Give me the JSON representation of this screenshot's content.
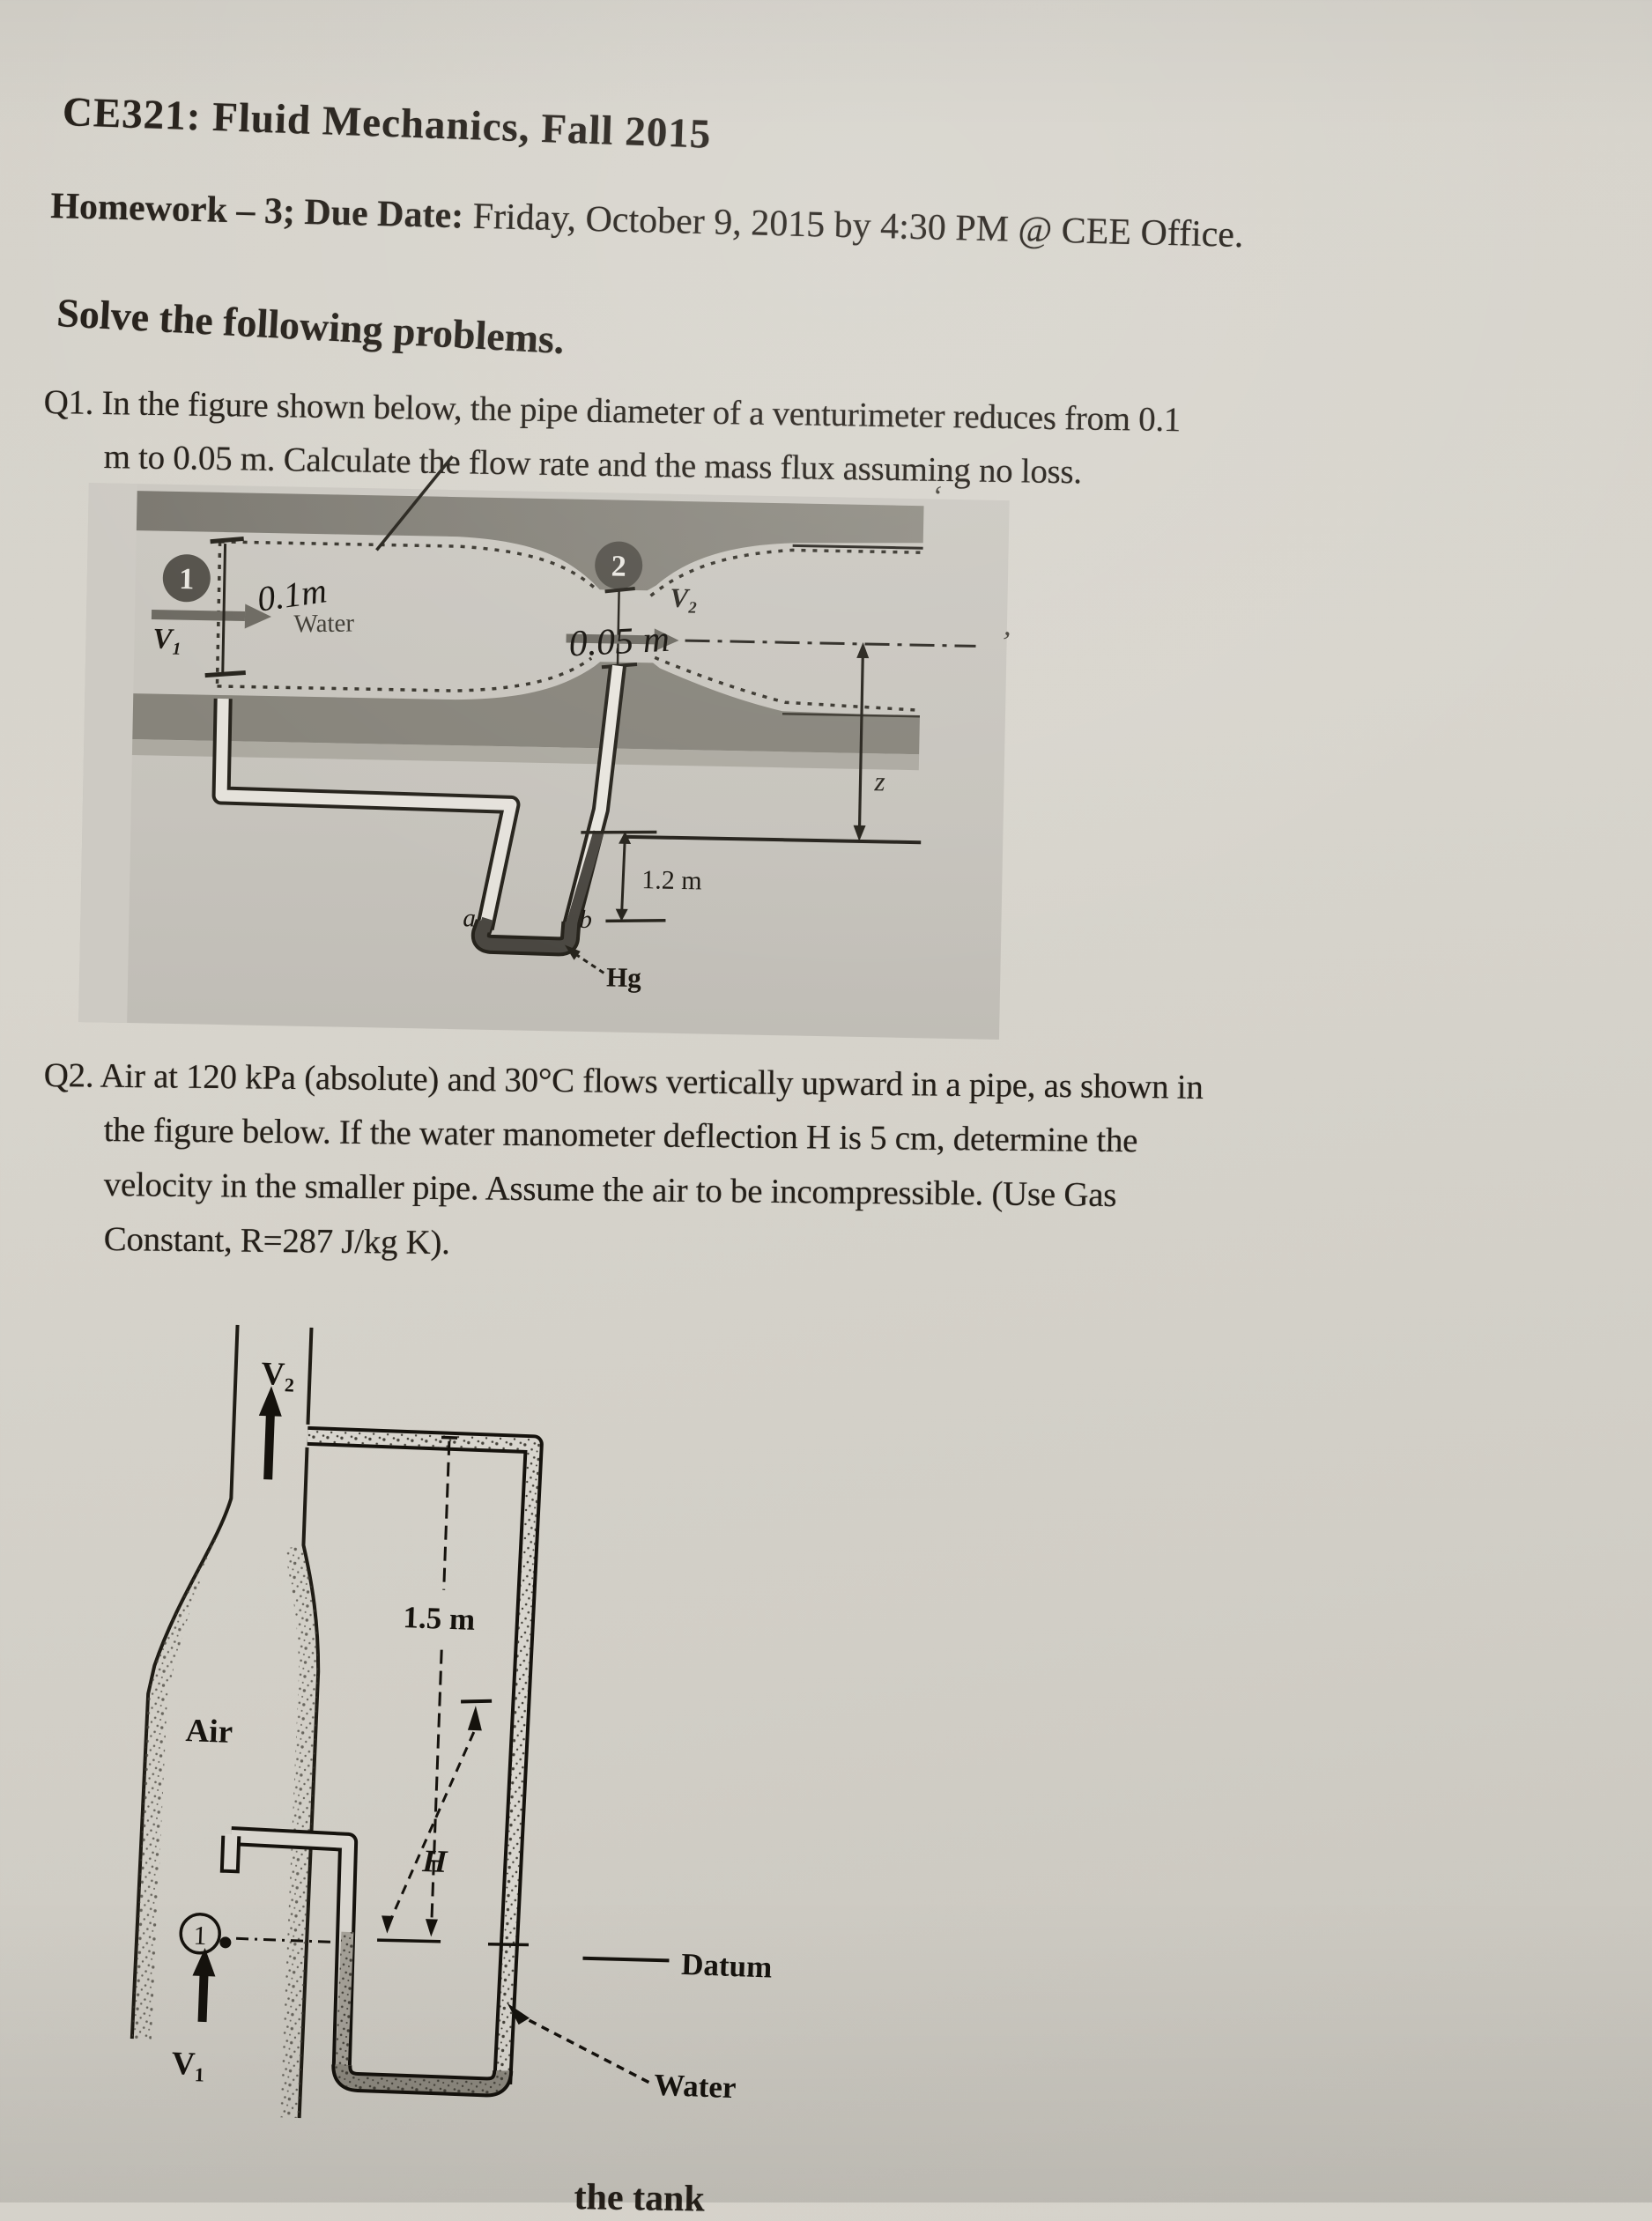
{
  "document": {
    "title": "CE321: Fluid Mechanics, Fall 2015",
    "homework_label": "Homework – 3; Due Date:",
    "homework_due": " Friday, October 9, 2015 by 4:30 PM @ CEE Office.",
    "instruction": "Solve the following problems.",
    "bottom_fragment": "the tank",
    "stray_mark_1": "’",
    "stray_mark_2": "‘"
  },
  "q1": {
    "lines": [
      "Q1. In the figure shown below, the pipe diameter of a venturimeter reduces from 0.1",
      "m to 0.05 m. Calculate the flow rate and the mass flux assuming no loss."
    ]
  },
  "q2": {
    "lines": [
      "Q2. Air at 120 kPa (absolute) and 30°C flows vertically upward in a pipe, as shown in",
      "the figure below. If the water manometer deflection H is 5 cm, determine the",
      "velocity in the smaller pipe. Assume the air to be incompressible. (Use Gas",
      "Constant, R=287 J/kg K)."
    ]
  },
  "fig1": {
    "station1": "1",
    "station2": "2",
    "v1": "V₁",
    "v2": "V₂",
    "water_label": "Water",
    "diameter1_handwritten": "0.1m",
    "diameter2_handwritten": "0.05 m",
    "label_a": "a",
    "label_b": "b",
    "mercury_height": "1.2 m",
    "mercury_label": "Hg",
    "elevation_label": "z"
  },
  "fig2": {
    "v2": "V₂",
    "height_label": "1.5 m",
    "air_label": "Air",
    "deflection_label": "H",
    "station1": "1",
    "v1": "V₁",
    "datum_label": "Datum",
    "water_label": "Water"
  },
  "colors": {
    "paper": "#d6d3cb",
    "ink": "#241f19",
    "figure_bg": "#c7c4bd",
    "wall_gray": "#837f77",
    "mercury": "#4a4741",
    "steel_gray": "#6d6a62"
  }
}
